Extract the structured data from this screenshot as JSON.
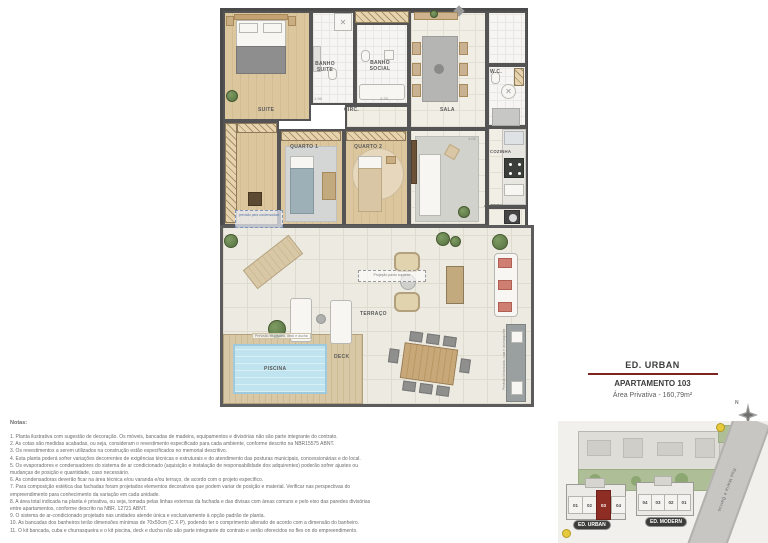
{
  "header": {
    "building_title": "ED. URBAN",
    "apartment_title": "APARTAMENTO 103",
    "private_area": "Área Privativa - 160,79m²"
  },
  "compass": {
    "north_label": "N"
  },
  "floor_plan": {
    "rooms": {
      "suite": "SUITE",
      "banho_suite": "BANHO SUITE",
      "banho_social": "BANHO SOCIAL",
      "circulacao": "CIRC.",
      "sala": "SALA",
      "wc": "W.C.",
      "quarto_1": "QUARTO 1",
      "quarto_2": "QUARTO 2",
      "cozinha": "COZINHA",
      "area_servico": "Á. SERV.",
      "terraco": "TERRAÇO",
      "deck": "DECK",
      "piscina": "PISCINA"
    },
    "annotations": {
      "projecao_pavimento": "Projeção pavto superior",
      "previsao_condensadora": "previsão para condensadora",
      "previsao_kit_piscina": "Previsão kit piscina, deck e ducha",
      "previsao_kit_bancada": "Previsão kit bancada, cuba e churrasqueira"
    },
    "dimensions": [
      "1.94",
      "2.23",
      "1.04"
    ]
  },
  "notes": {
    "title": "Notas:",
    "items": [
      "1. Planta ilustrativa com sugestão de decoração. Os móveis, bancadas de madeira, equipamentos e divisórias não são parte integrante do contrato.",
      "2. As cotas são medidas acabadas, ou seja, consideram o revestimento especificado para cada ambiente, conforme descrito na NBR15575 ABNT.",
      "3. Os revestimentos a serem utilizados na construção estão especificados no memorial descritivo.",
      "4. Esta planta poderá sofrer variações decorrentes de exigências técnicas e estruturais e do atendimento das posturas municipais, concessionárias e do local.",
      "5. Os evaporadores e condensadores do sistema de ar condicionado (aquisição e instalação de responsabilidade dos adquirentes) poderão sofrer ajustes ou mudanças de posição e quantidade, caso necessário.",
      "6. As condensadoras deverão ficar na área técnica e/ou varanda e/ou terraço, de acordo com o projeto específico.",
      "7. Para composição estética das fachadas foram projetados elementos decorativos que podem variar de posição e material. Verificar nas perspectivas do empreendimento para conhecimento da variação em cada unidade.",
      "8. A área total indicada na planta é privativa, ou seja, tomada pelas linhas externas da fachada e das divisas com áreas comuns e pelo eixo das paredes divisórias entre apartamentos, conforme descrito na NBR. 12721 ABNT.",
      "9. O sistema de ar-condicionado projetado nas unidades atende única e exclusivamente à opção padrão de planta.",
      "10. As bancadas dos banheiros terão dimensões mínimas de 70x50cm (C X P), podendo ter o comprimento alterado de acordo com a dimensão do banheiro.",
      "11. O kit bancada, cuba e churrasqueira e o kit piscina, deck e ducha não são parte integrante do contrato e serão oferecidos no flex on do empreendimento."
    ]
  },
  "site_plan": {
    "street_name": "Rua Maria e Barros",
    "buildings": [
      {
        "name": "ED. URBAN",
        "units": [
          "01",
          "02",
          "03",
          "04"
        ],
        "highlighted_unit": "03"
      },
      {
        "name": "ED. MODERN",
        "units": [
          "04",
          "03",
          "02",
          "01"
        ]
      }
    ]
  },
  "colors": {
    "accent_red": "#8e2d23",
    "rule_maroon": "#7c241f",
    "pool_blue": "#bfe4ef",
    "wall_gray": "#4a4a4a"
  }
}
